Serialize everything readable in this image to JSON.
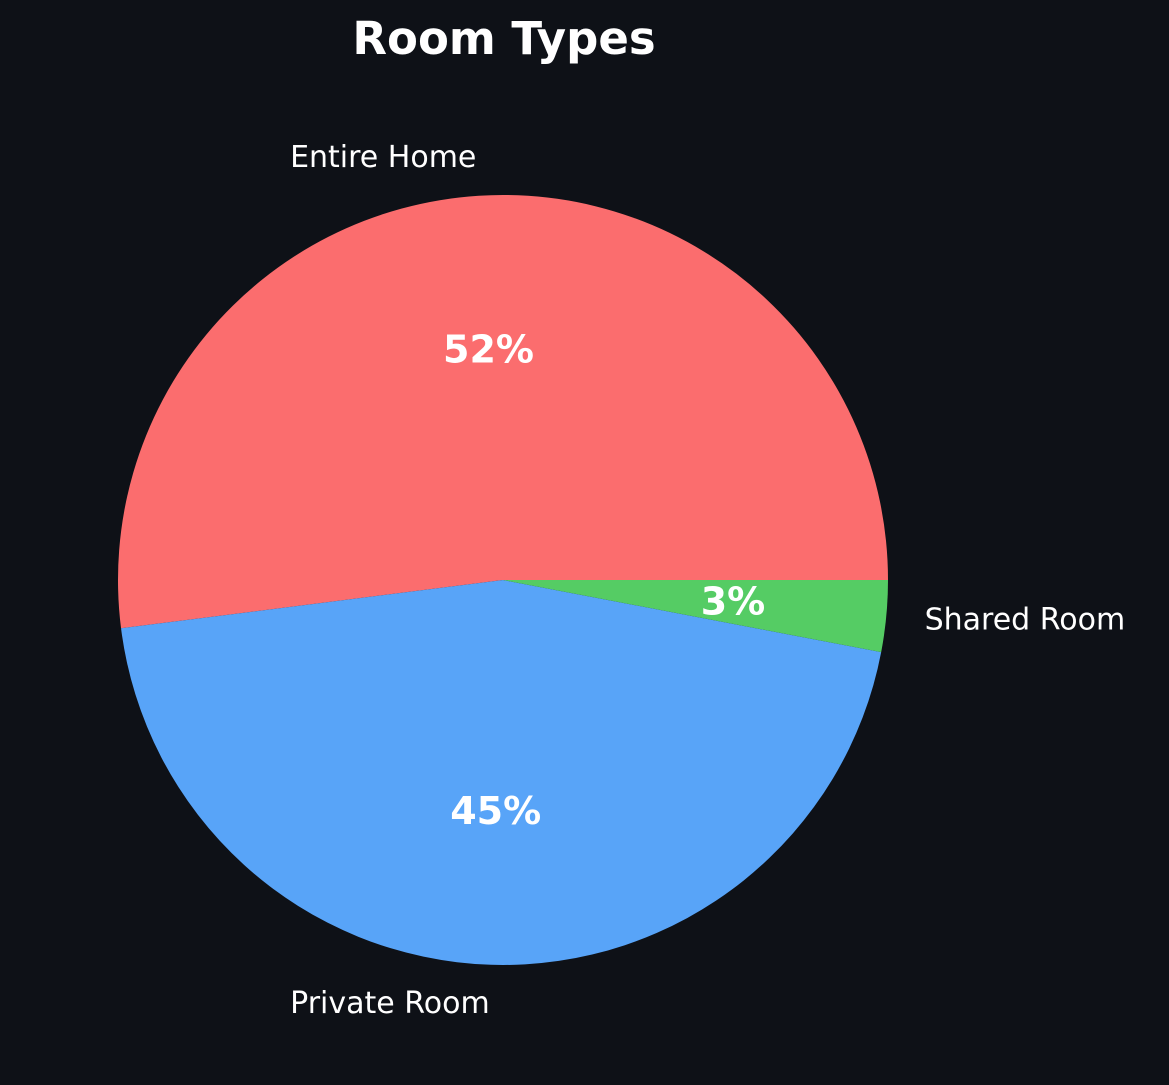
{
  "colors": {
    "background": "#0e1117",
    "text": "#ffffff"
  },
  "chart_data": {
    "type": "pie",
    "title": "Room Types",
    "labels": [
      "Entire Home",
      "Private Room",
      "Shared Room"
    ],
    "values": [
      52,
      45,
      3
    ],
    "pct_labels": [
      "52%",
      "45%",
      "3%"
    ],
    "slice_colors": [
      "#fb6d6e",
      "#58a4f8",
      "#55cc64"
    ],
    "start_angle_deg": 0,
    "direction": "counterclockwise",
    "legend_position": "none",
    "grid": false
  }
}
